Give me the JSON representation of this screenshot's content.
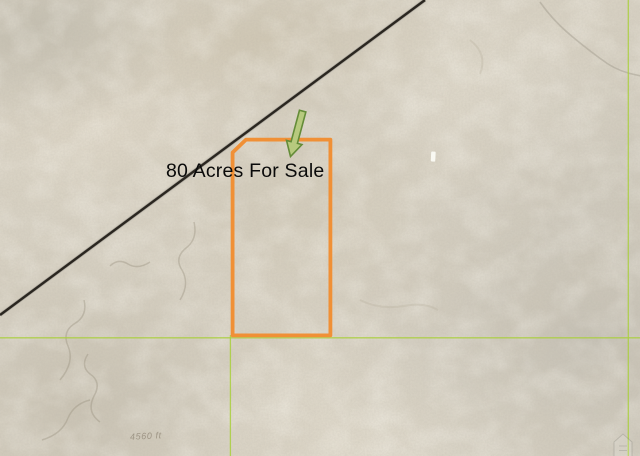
{
  "map": {
    "annotation_label": "80 Acres For Sale",
    "scale_label": "4560 ft"
  },
  "icons": {
    "parcel_pointer": "green-down-arrow-icon",
    "watermark": "house-logo-icon"
  },
  "theme": {
    "terrain_base": "#D8D2C4",
    "parcel_outline": "#F09036",
    "section_line": "#A9CF3D",
    "road": "#2A2620",
    "arrow_fill": "#B7CA7E",
    "arrow_stroke": "#648C38",
    "label_color": "#0A0A0A",
    "scale_label_color": "rgba(120,110,92,0.55)"
  }
}
